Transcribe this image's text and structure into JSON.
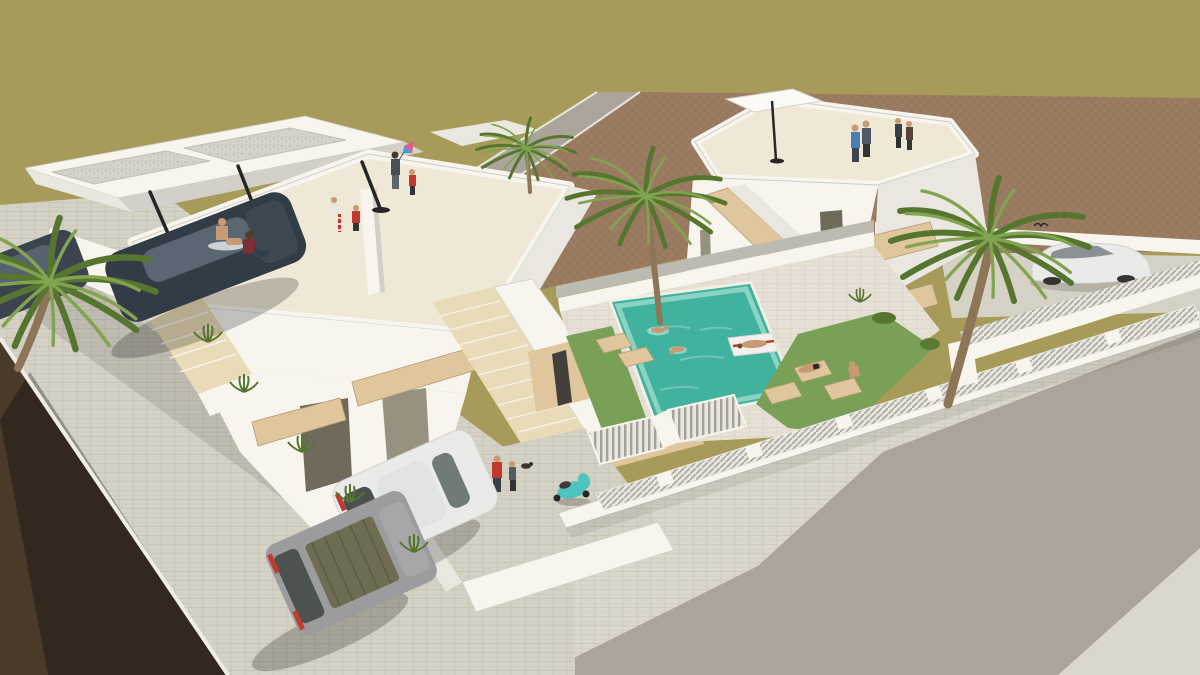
{
  "scene": {
    "description": "Aerial 3D architectural rendering of a residential development: two modern white villas with rooftop solariums where people relax, a turquoise swimming pool with swimmers and a float, lawn gardens with wooden sun loungers, palm trees, white slatted fences, a vacant brown plot, parked cars, a teal scooter, a paved sidewalk and a curved asphalt street.",
    "left_roof_people": 7,
    "right_roof_people": 4,
    "pool_swimmers": 3,
    "vehicle_count": 5,
    "palm_tree_count": 4
  },
  "colors": {
    "ground_olive": "#a69b58",
    "dirt_plot": "#9d7d62",
    "soil_dark": "#4a3a2a",
    "asphalt": "#aaa49b",
    "sidewalk": "#dbd7cc",
    "driveway": "#d5d1c5",
    "deck": "#e6e1d4",
    "wall_white": "#f8f5ef",
    "wall_light": "#eae7e0",
    "wall_shade": "#d3d0c9",
    "wall_dark": "#bdbab2",
    "roof_floor": "#f0e8d6",
    "gravel": "#d6d2c9",
    "wood": "#dfc69c",
    "wood_light": "#e9dab8",
    "window_dark": "#6f6a5b",
    "window_glass": "#97927f",
    "pool_water": "#41b29d",
    "pool_light": "#93d6c8",
    "grass": "#7aa058",
    "palm_green": "#567630",
    "palm_light": "#82a450",
    "trunk": "#8d7557",
    "car_dark": "#323c47",
    "car_glass": "#5b6673",
    "car_white": "#eaebe9",
    "van_gray": "#9c9b9e",
    "van_tarp": "#6e6d52",
    "accent_red": "#c03a2e",
    "shirt_blue": "#4a7fb5",
    "scooter_teal": "#4fc3bd",
    "skin": "#c89a73",
    "kite_pink": "#e05a8a",
    "kite_blue": "#3aa0d8",
    "dark": "#262626"
  }
}
